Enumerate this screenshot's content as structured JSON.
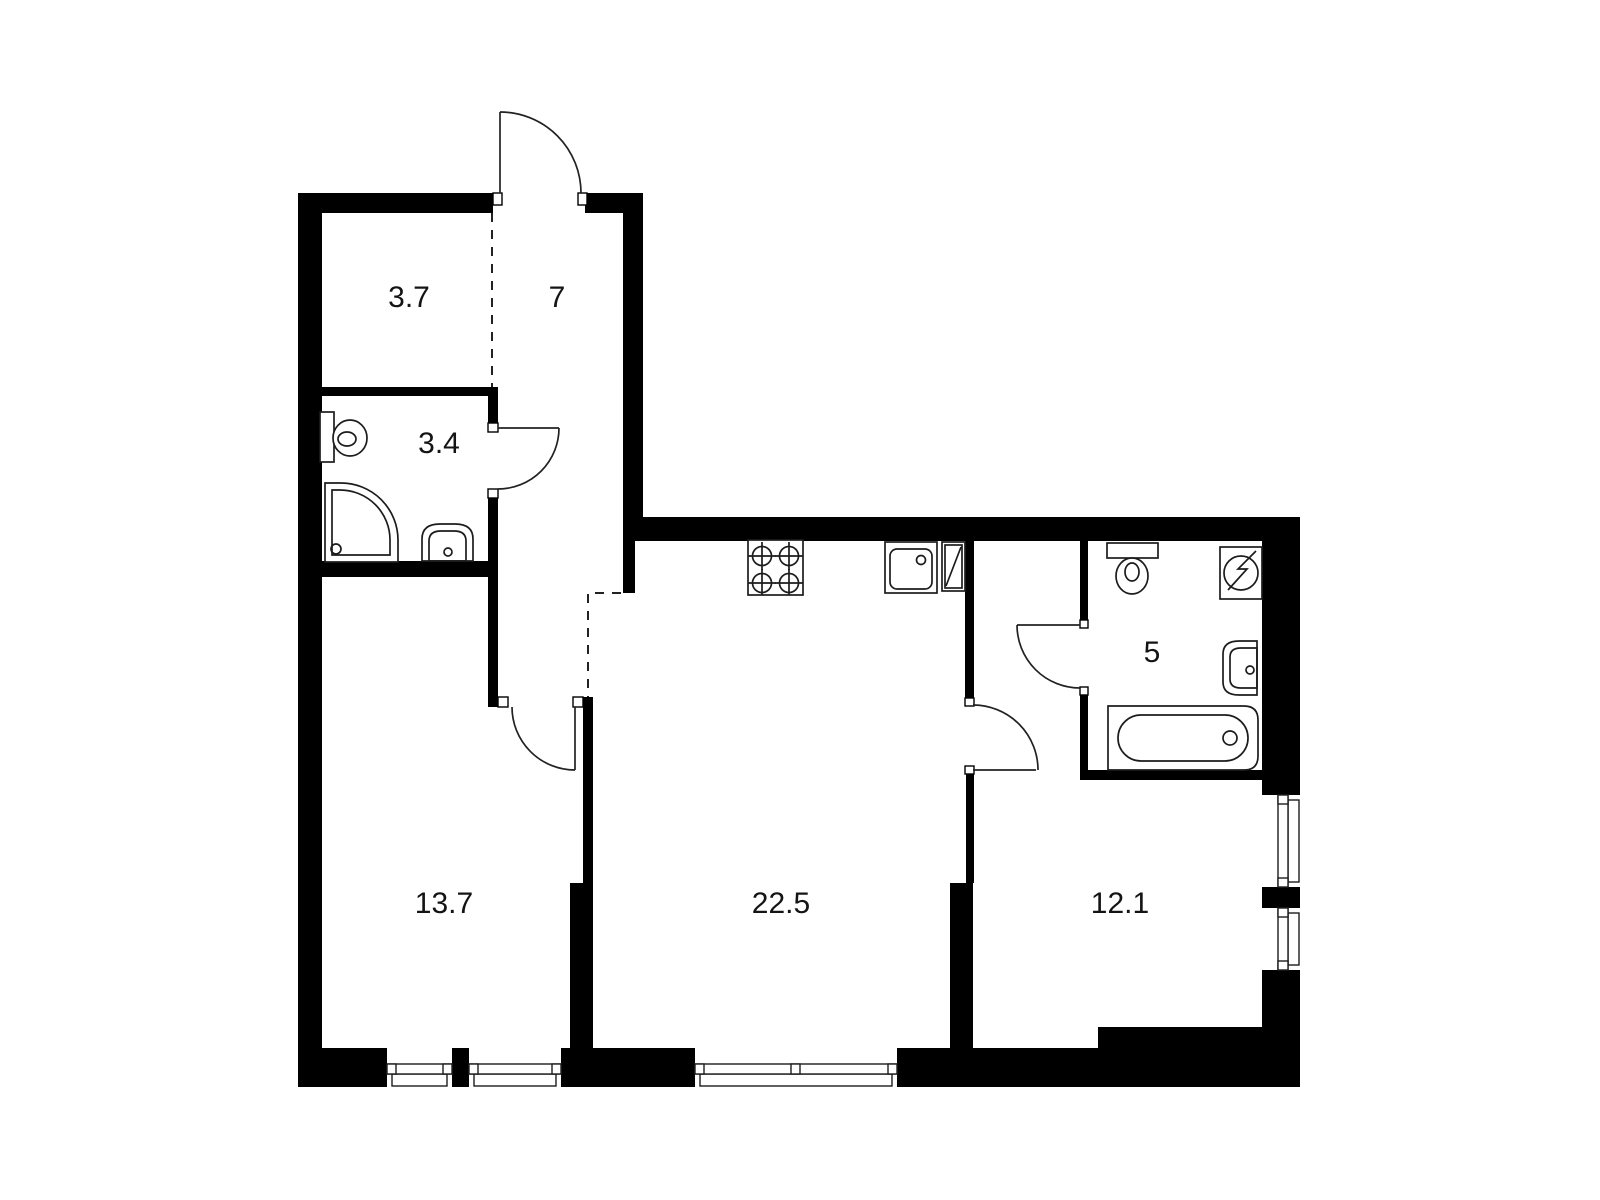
{
  "plan": {
    "type": "apartment-floor-plan",
    "background_color": "#ffffff",
    "wall_color": "#000000",
    "line_color": "#1c1c1c",
    "label_color": "#141414",
    "rooms": [
      {
        "name": "closet-top-left",
        "area_label": "3.7"
      },
      {
        "name": "hallway",
        "area_label": "7"
      },
      {
        "name": "bathroom-small",
        "area_label": "3.4"
      },
      {
        "name": "room-left",
        "area_label": "13.7"
      },
      {
        "name": "kitchen-living",
        "area_label": "22.5"
      },
      {
        "name": "bathroom-large",
        "area_label": "5"
      },
      {
        "name": "room-right",
        "area_label": "12.1"
      }
    ],
    "fixtures": [
      "toilet-small-bathroom",
      "shower-cabin",
      "washbasin-small-bathroom",
      "cooktop-4-burner",
      "kitchen-sink",
      "refrigerator",
      "toilet-large-bathroom",
      "washing-machine",
      "washbasin-large-bathroom",
      "bathtub"
    ],
    "doors": [
      "entrance-door",
      "bathroom-small-door",
      "room-left-door",
      "kitchen-to-room-right-door",
      "bathroom-large-door"
    ],
    "windows": [
      "bottom-window-1",
      "bottom-window-2",
      "bottom-window-wide",
      "right-window-tall",
      "right-window-short"
    ]
  }
}
